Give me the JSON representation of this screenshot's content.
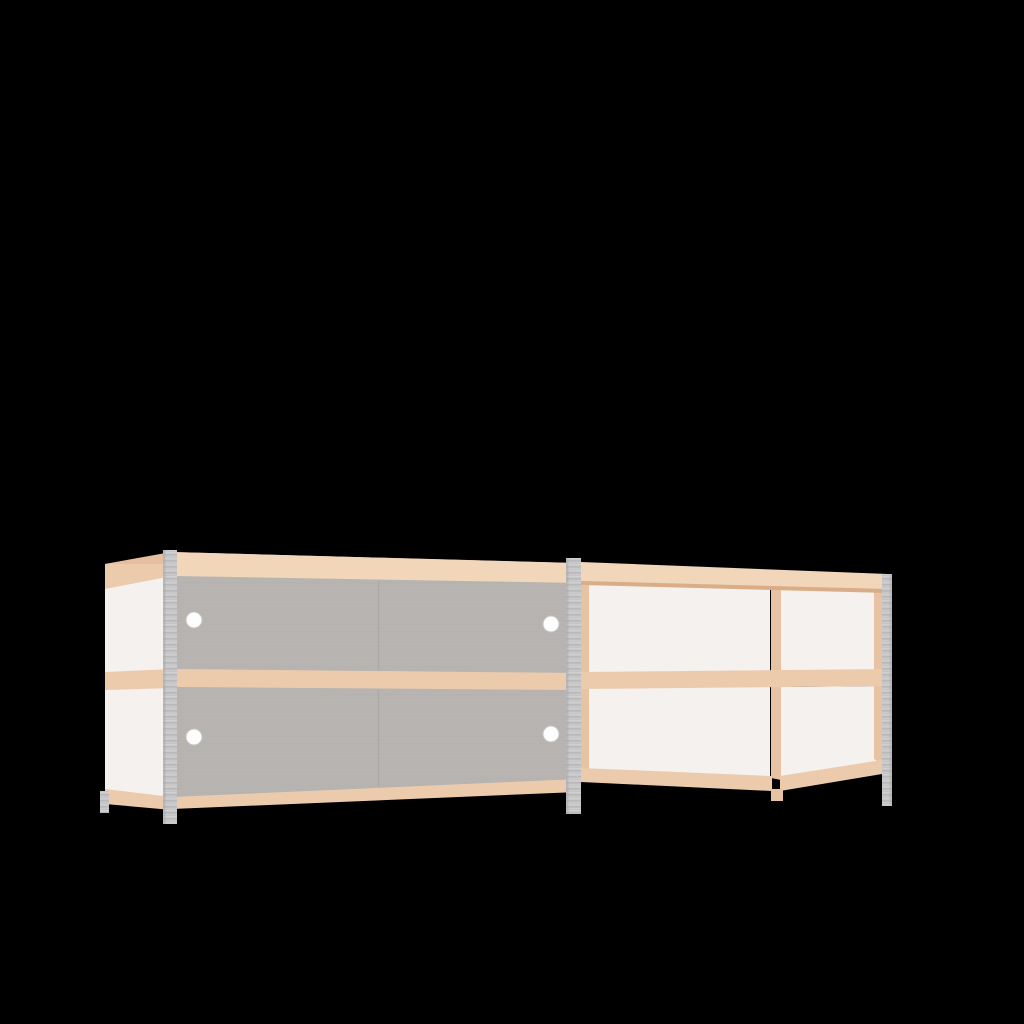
{
  "meta": {
    "type": "3d-product-render",
    "description": "3D render of a low two-section shelving sideboard on a plain black background, viewed from the front-left. The left section is closed with two rows of gray sliding doors, each door having a small round white finger hole. The right section is open shelving with white back panels, a wooden center divider and wooden shelf bands. Light beech-colored wood frames the top, middle and bottom, and gray slotted-steel angle posts form the legs/uprights.",
    "background": "#000000"
  },
  "colors": {
    "background": "#000000",
    "wood_face": "#f1d6b9",
    "wood_top": "#e5bf9f",
    "wood_band": "#eccbad",
    "wood_deep": "#d9ad87",
    "wood_inner": "#e7c3a4",
    "door": "#b7b4b1",
    "door_line": "#aba8a5",
    "door_seam": "#a39f9c",
    "panel_white": "#f4f1ee",
    "metal": "#c3c3c5",
    "metal_hi": "#d8d8da",
    "metal_lo": "#a4a4a6",
    "hole": "#fdfdfd",
    "hole_ring": "#c9c5c1"
  },
  "scene": {
    "left_cabinet": {
      "label": "closed cabinet section with sliding doors",
      "door_rows": 2,
      "doors_per_row": 2,
      "finger_holes": 4
    },
    "right_unit": {
      "label": "open shelving section with center divider",
      "bays": 4
    },
    "posts": {
      "label": "gray slotted metal corner posts",
      "count": 4
    }
  }
}
